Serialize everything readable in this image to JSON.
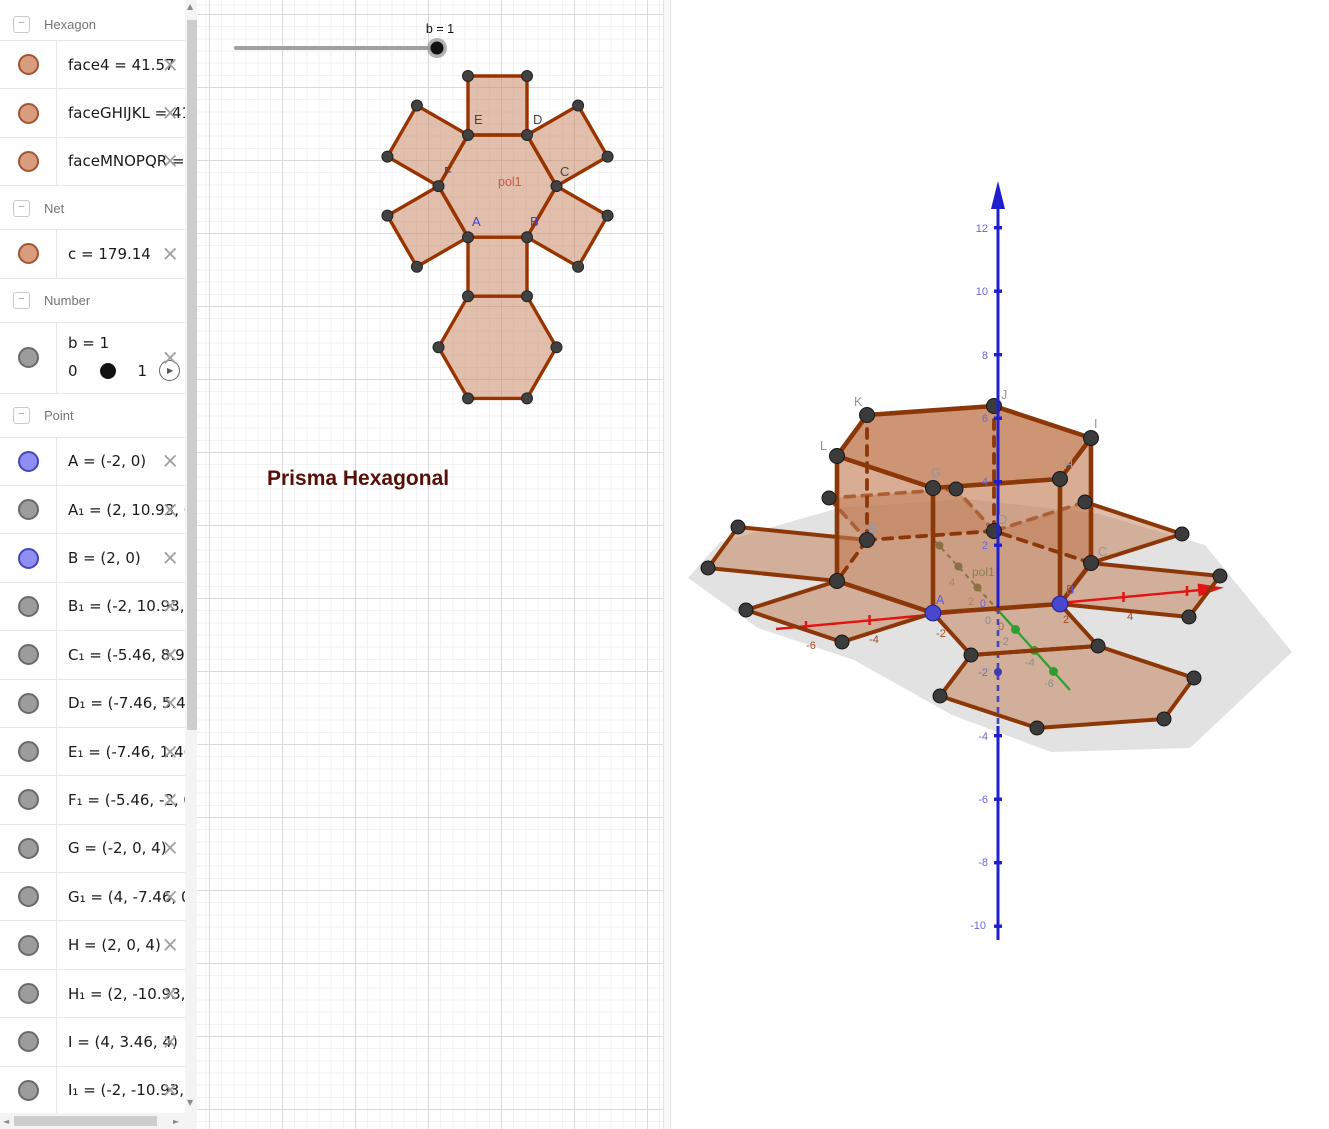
{
  "icons": {
    "collapse": "−",
    "close": "×",
    "play": "▶",
    "scroll_up": "▲",
    "scroll_down": "▼",
    "scroll_left": "◄",
    "scroll_right": "►"
  },
  "sidebar": {
    "sections": [
      {
        "label": "Hexagon",
        "items": [
          {
            "label": "face4 = 41.57",
            "dot": "orange"
          },
          {
            "label": "faceGHIJKL = 41.57",
            "dot": "orange"
          },
          {
            "label": "faceMNOPQR = 41",
            "dot": "orange"
          }
        ]
      },
      {
        "label": "Net",
        "items": [
          {
            "label": "c = 179.14",
            "dot": "orange"
          }
        ]
      },
      {
        "label": "Number",
        "items": [
          {
            "label": "b = 1",
            "dot": "gray",
            "slider": {
              "min": "0",
              "max": "1"
            }
          }
        ]
      },
      {
        "label": "Point",
        "items": [
          {
            "label": "A = (-2, 0)",
            "dot": "blue"
          },
          {
            "label": "A₁ = (2, 10.93, 0)",
            "dot": "gray"
          },
          {
            "label": "B = (2, 0)",
            "dot": "blue"
          },
          {
            "label": "B₁ = (-2, 10.93, 0)",
            "dot": "gray"
          },
          {
            "label": "C₁ = (-5.46, 8.93, 0)",
            "dot": "gray"
          },
          {
            "label": "D₁ = (-7.46, 5.46, 0)",
            "dot": "gray"
          },
          {
            "label": "E₁ = (-7.46, 1.46, 0)",
            "dot": "gray"
          },
          {
            "label": "F₁ = (-5.46, -2, 0)",
            "dot": "gray"
          },
          {
            "label": "G = (-2, 0, 4)",
            "dot": "gray"
          },
          {
            "label": "G₁ = (4, -7.46, 0)",
            "dot": "gray"
          },
          {
            "label": "H = (2, 0, 4)",
            "dot": "gray"
          },
          {
            "label": "H₁ = (2, -10.93, 0)",
            "dot": "gray"
          },
          {
            "label": "I = (4, 3.46, 4)",
            "dot": "gray"
          },
          {
            "label": "I₁ = (-2, -10.93, 0)",
            "dot": "gray"
          }
        ]
      }
    ]
  },
  "g2d": {
    "slider_label": "b = 1",
    "title": "Prisma Hexagonal",
    "poly_label": "pol1",
    "points": {
      "A": "A",
      "B": "B",
      "C": "C",
      "D": "D",
      "E": "E",
      "F": "F"
    }
  },
  "g3d": {
    "poly_label": "pol1",
    "points": {
      "A": "A",
      "B": "B",
      "C": "C",
      "D": "D",
      "E": "E",
      "G": "G",
      "H": "H",
      "I": "I",
      "J": "J",
      "K": "K",
      "L": "L"
    },
    "xticks": [
      "-6",
      "-4",
      "-2",
      "2",
      "4"
    ],
    "yticks": [
      "4",
      "2",
      "0",
      "-2",
      "-4",
      "-6"
    ],
    "zticks": [
      "12",
      "10",
      "8",
      "6",
      "4",
      "2",
      "-2",
      "-4",
      "-6",
      "-8",
      "-10"
    ],
    "origin": {
      "x0": "0",
      "z0": "0"
    }
  },
  "colors": {
    "object_fill": "#c98a68",
    "object_stroke": "#993300",
    "axis_x": "#e21414",
    "axis_y": "#2f9e2f",
    "axis_z": "#1f1fd0",
    "point_free": "#8f8ff2",
    "point_aux": "#9c9c9c",
    "poly_orange": "#d89c80",
    "title": "#561007"
  }
}
